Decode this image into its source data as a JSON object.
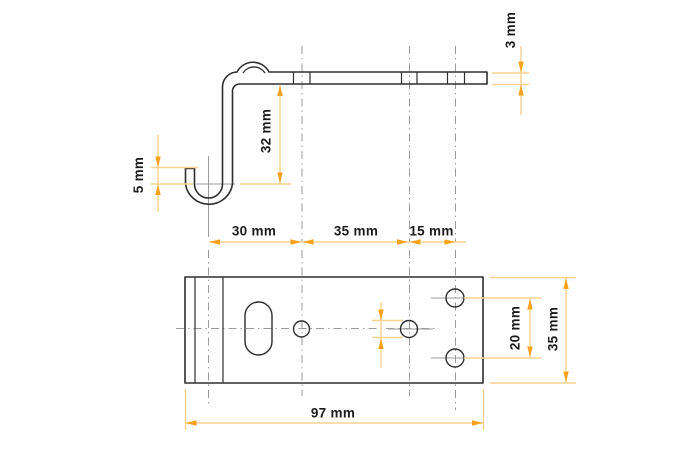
{
  "colors": {
    "background": "#ffffff",
    "outline": "#2e2e2e",
    "centerline": "#9b9b9b",
    "dimension_line": "#fbd28f",
    "dimension_arrow": "#f7a11c",
    "label_text": "#1c1c1c"
  },
  "side_view": {
    "dims": {
      "thickness": "3 mm",
      "height": "32 mm",
      "hook_lip": "5 mm"
    }
  },
  "plan_view": {
    "dims": {
      "hook_to_hole1": "30 mm",
      "hole1_to_hole2": "35 mm",
      "hole2_to_holes3": "15 mm",
      "right_holes_spacing": "20 mm",
      "plate_depth": "35 mm",
      "plate_length": "97 mm"
    }
  }
}
